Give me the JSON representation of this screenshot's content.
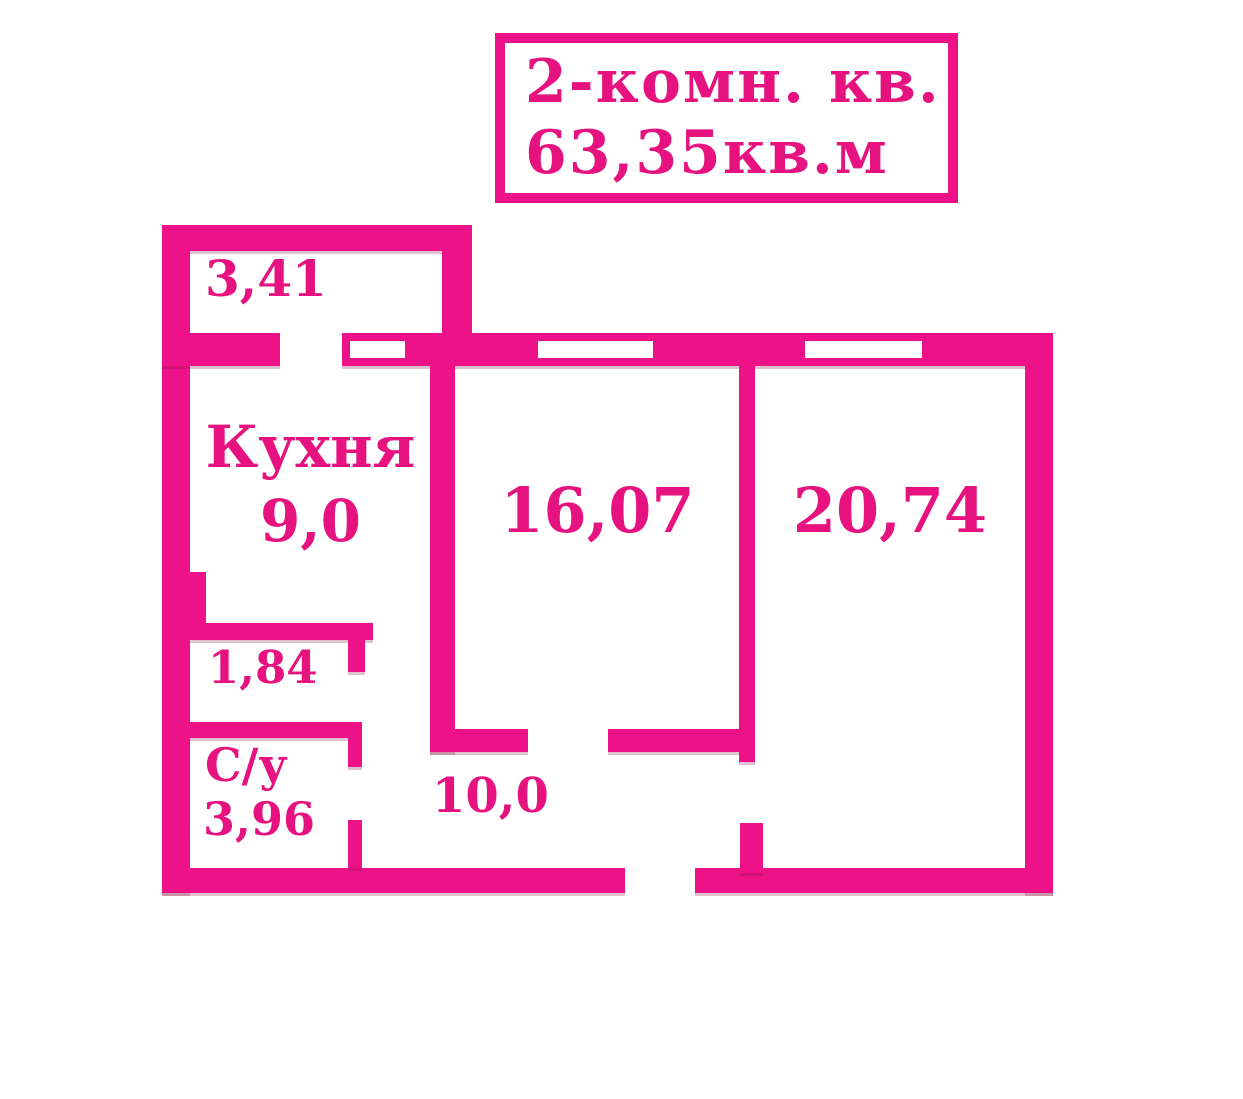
{
  "meta": {
    "accent_color": "#ee1289",
    "text_color": "#e5127f",
    "background_color": "#ffffff",
    "drawing_type": "apartment floor plan"
  },
  "title_box": {
    "line1": "2-комн. кв.",
    "line2": "63,35кв.м"
  },
  "rooms": {
    "balcony": {
      "area": "3,41"
    },
    "kitchen": {
      "name": "Кухня",
      "area": "9,0"
    },
    "living_room": {
      "area": "16,07"
    },
    "bedroom": {
      "area": "20,74"
    },
    "closet": {
      "area": "1,84"
    },
    "bathroom": {
      "name": "С/у",
      "area": "3,96"
    },
    "hallway": {
      "area": "10,0"
    }
  }
}
